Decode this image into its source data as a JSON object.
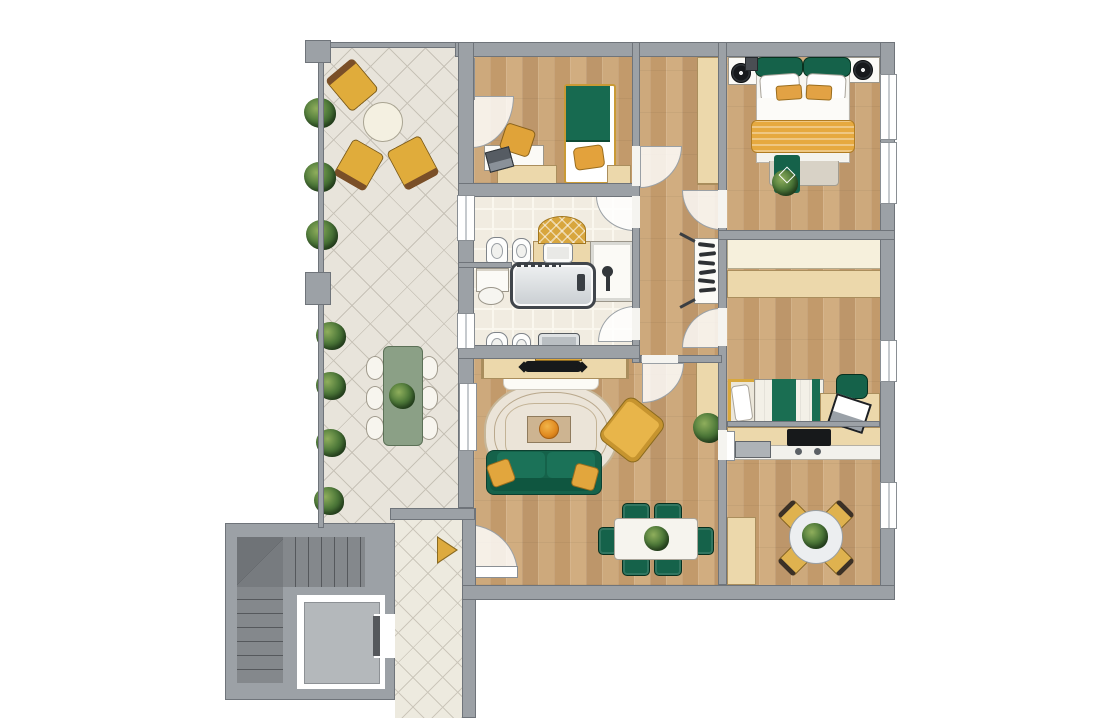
{
  "title": "Apartment floor plan — top-down 2D render",
  "type": "floor-plan",
  "palette": {
    "wall_gray": "#9ca1a6",
    "wood_floor": "#c7a274",
    "terrace_tile": "#e8e4db",
    "bath_tile": "#f1ece1",
    "accent_green": "#15624a",
    "accent_gold": "#e0ac3b",
    "accent_orange": "#e6a93f",
    "stair_gray": "#7e8286",
    "fixture_white": "#fdfdfc"
  },
  "rooms": [
    {
      "id": "terrace",
      "name": "Terrace",
      "furniture": [
        "three gold lounge chairs",
        "round bistro table",
        "green garden dining table",
        "six white garden chairs",
        "seven shrubs",
        "two pillars"
      ]
    },
    {
      "id": "bedroom-kids",
      "name": "Kids bedroom",
      "furniture": [
        "single bed with green duvet",
        "gold pillow",
        "white desk",
        "laptop",
        "gold desk chair",
        "two low dressers"
      ]
    },
    {
      "id": "hallway",
      "name": "Hallway",
      "furniture": [
        "tall wardrobe",
        "walk-in closet with hangers and folding doors"
      ]
    },
    {
      "id": "master-bedroom",
      "name": "Master bedroom",
      "furniture": [
        "double bed with green headboard",
        "gold blanket",
        "two white nightstands",
        "two round speakers",
        "foot bench with green throw",
        "floor plant"
      ]
    },
    {
      "id": "bathroom-top",
      "name": "Bathroom (top)",
      "furniture": [
        "toilet",
        "bidet",
        "vanity with sink",
        "golden half-round rug",
        "shower cabin"
      ]
    },
    {
      "id": "bathroom-bottom",
      "name": "Bathroom (bottom)",
      "furniture": [
        "bathtub",
        "towel shelf with basket",
        "toilet",
        "bidet",
        "vanity with yellow cabinet"
      ]
    },
    {
      "id": "bedroom-guest",
      "name": "Guest bedroom",
      "furniture": [
        "single bed with green striped cover",
        "cream sideboard",
        "wood sideboard",
        "desk",
        "laptop",
        "green desk chair"
      ]
    },
    {
      "id": "kitchen",
      "name": "Kitchen",
      "furniture": [
        "counter with double sink",
        "black cooktop with hood",
        "tall cabinet",
        "round dining table",
        "four gold chairs",
        "table plant"
      ]
    },
    {
      "id": "living-room",
      "name": "Living room",
      "furniture": [
        "TV sideboard",
        "flat TV",
        "white bench pad",
        "ornate rug",
        "coffee table with orange bowl",
        "green sofa with gold pillows",
        "gold armchair",
        "white dining table",
        "six green chairs",
        "tall cabinet",
        "floor plant",
        "table plant"
      ]
    },
    {
      "id": "stairwell",
      "name": "Stairwell",
      "furniture": [
        "L-shaped staircase",
        "elevator with cab and door"
      ]
    },
    {
      "id": "entry-hall",
      "name": "Entry hall",
      "furniture": [
        "gold entrance arrow"
      ]
    }
  ]
}
